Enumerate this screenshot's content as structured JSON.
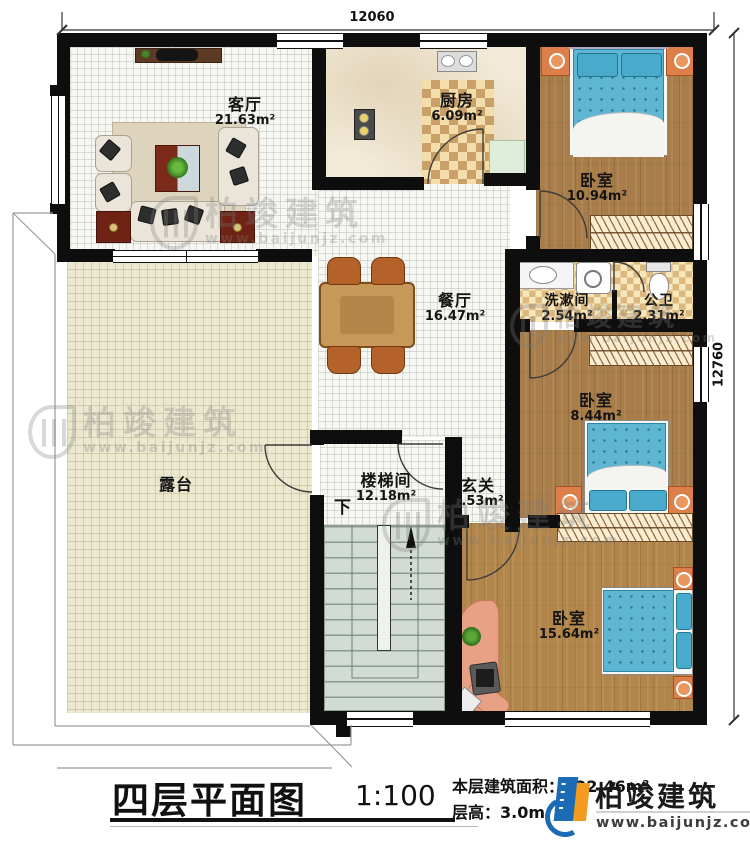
{
  "dimensions": {
    "top": "12060",
    "right": "12760"
  },
  "rooms": {
    "living": {
      "name": "客厅",
      "area": "21.63m²"
    },
    "kitchen": {
      "name": "厨房",
      "area": "6.09m²"
    },
    "bedroom1": {
      "name": "卧室",
      "area": "10.94m²"
    },
    "dining": {
      "name": "餐厅",
      "area": "16.47m²"
    },
    "washroom": {
      "name": "洗漱间",
      "area": "2.54m²"
    },
    "toilet": {
      "name": "公卫",
      "area": "2.31m²"
    },
    "bedroom2": {
      "name": "卧室",
      "area": "8.44m²"
    },
    "foyer": {
      "name": "玄关",
      "area": "3.53m²"
    },
    "stairwell": {
      "name": "楼梯间",
      "area": "12.18m²"
    },
    "bedroom3": {
      "name": "卧室",
      "area": "15.64m²"
    },
    "terrace": {
      "name": "露台"
    }
  },
  "stairs": {
    "direction_label": "下"
  },
  "title": {
    "plan_name": "四层平面图",
    "scale": "1:100",
    "floor_area": "本层建筑面积：122.46m²",
    "floor_height": "层高：3.0m"
  },
  "watermark": {
    "brand": "柏竣建筑",
    "url": "www.baijunjz.com"
  },
  "brand": {
    "name": "柏竣建筑",
    "url": "www.baijunjz.com"
  },
  "colors": {
    "wall": "#0e0e0e",
    "wood_floor": "#a87d49",
    "terrace_floor": "#ece8d0",
    "bed_mattress": "#5fb6d2",
    "nightstand": "#dd7f4a",
    "brand_blue": "#1b6cb5",
    "brand_orange": "#f29b1d"
  }
}
